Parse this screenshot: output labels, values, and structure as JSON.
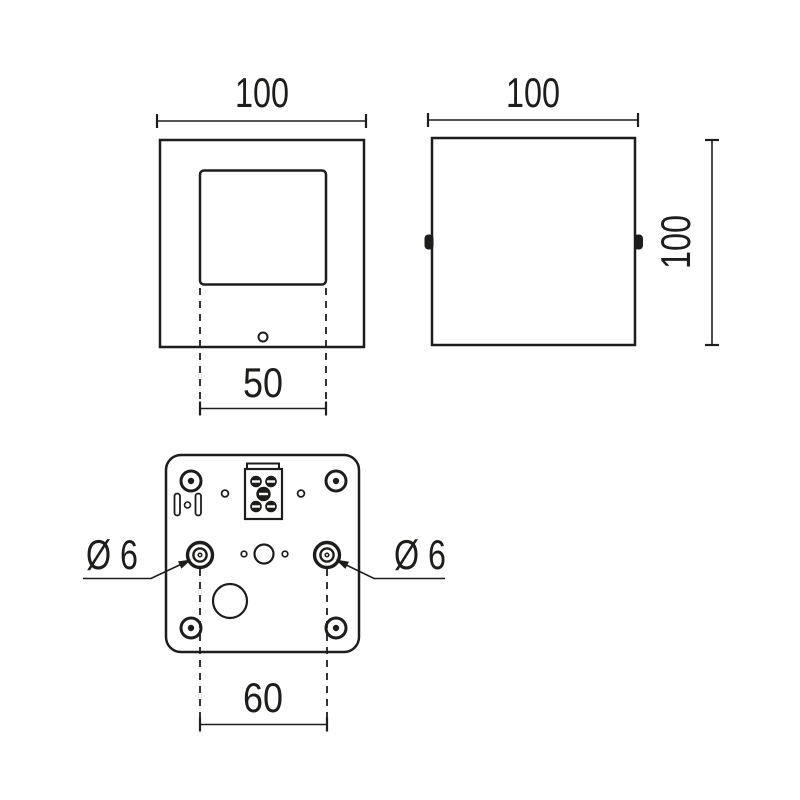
{
  "drawing": {
    "colors": {
      "body_gray": "#c7c7c7",
      "line": "#1d1d1b"
    },
    "front_view": {
      "width_dim": "100",
      "aperture_width_dim": "50"
    },
    "side_view": {
      "width_dim": "100",
      "height_dim": "100"
    },
    "bottom_view": {
      "mounting_hole_spacing_dim": "60",
      "mounting_hole_left_dia": "Ø 6",
      "mounting_hole_right_dia": "Ø 6"
    }
  }
}
